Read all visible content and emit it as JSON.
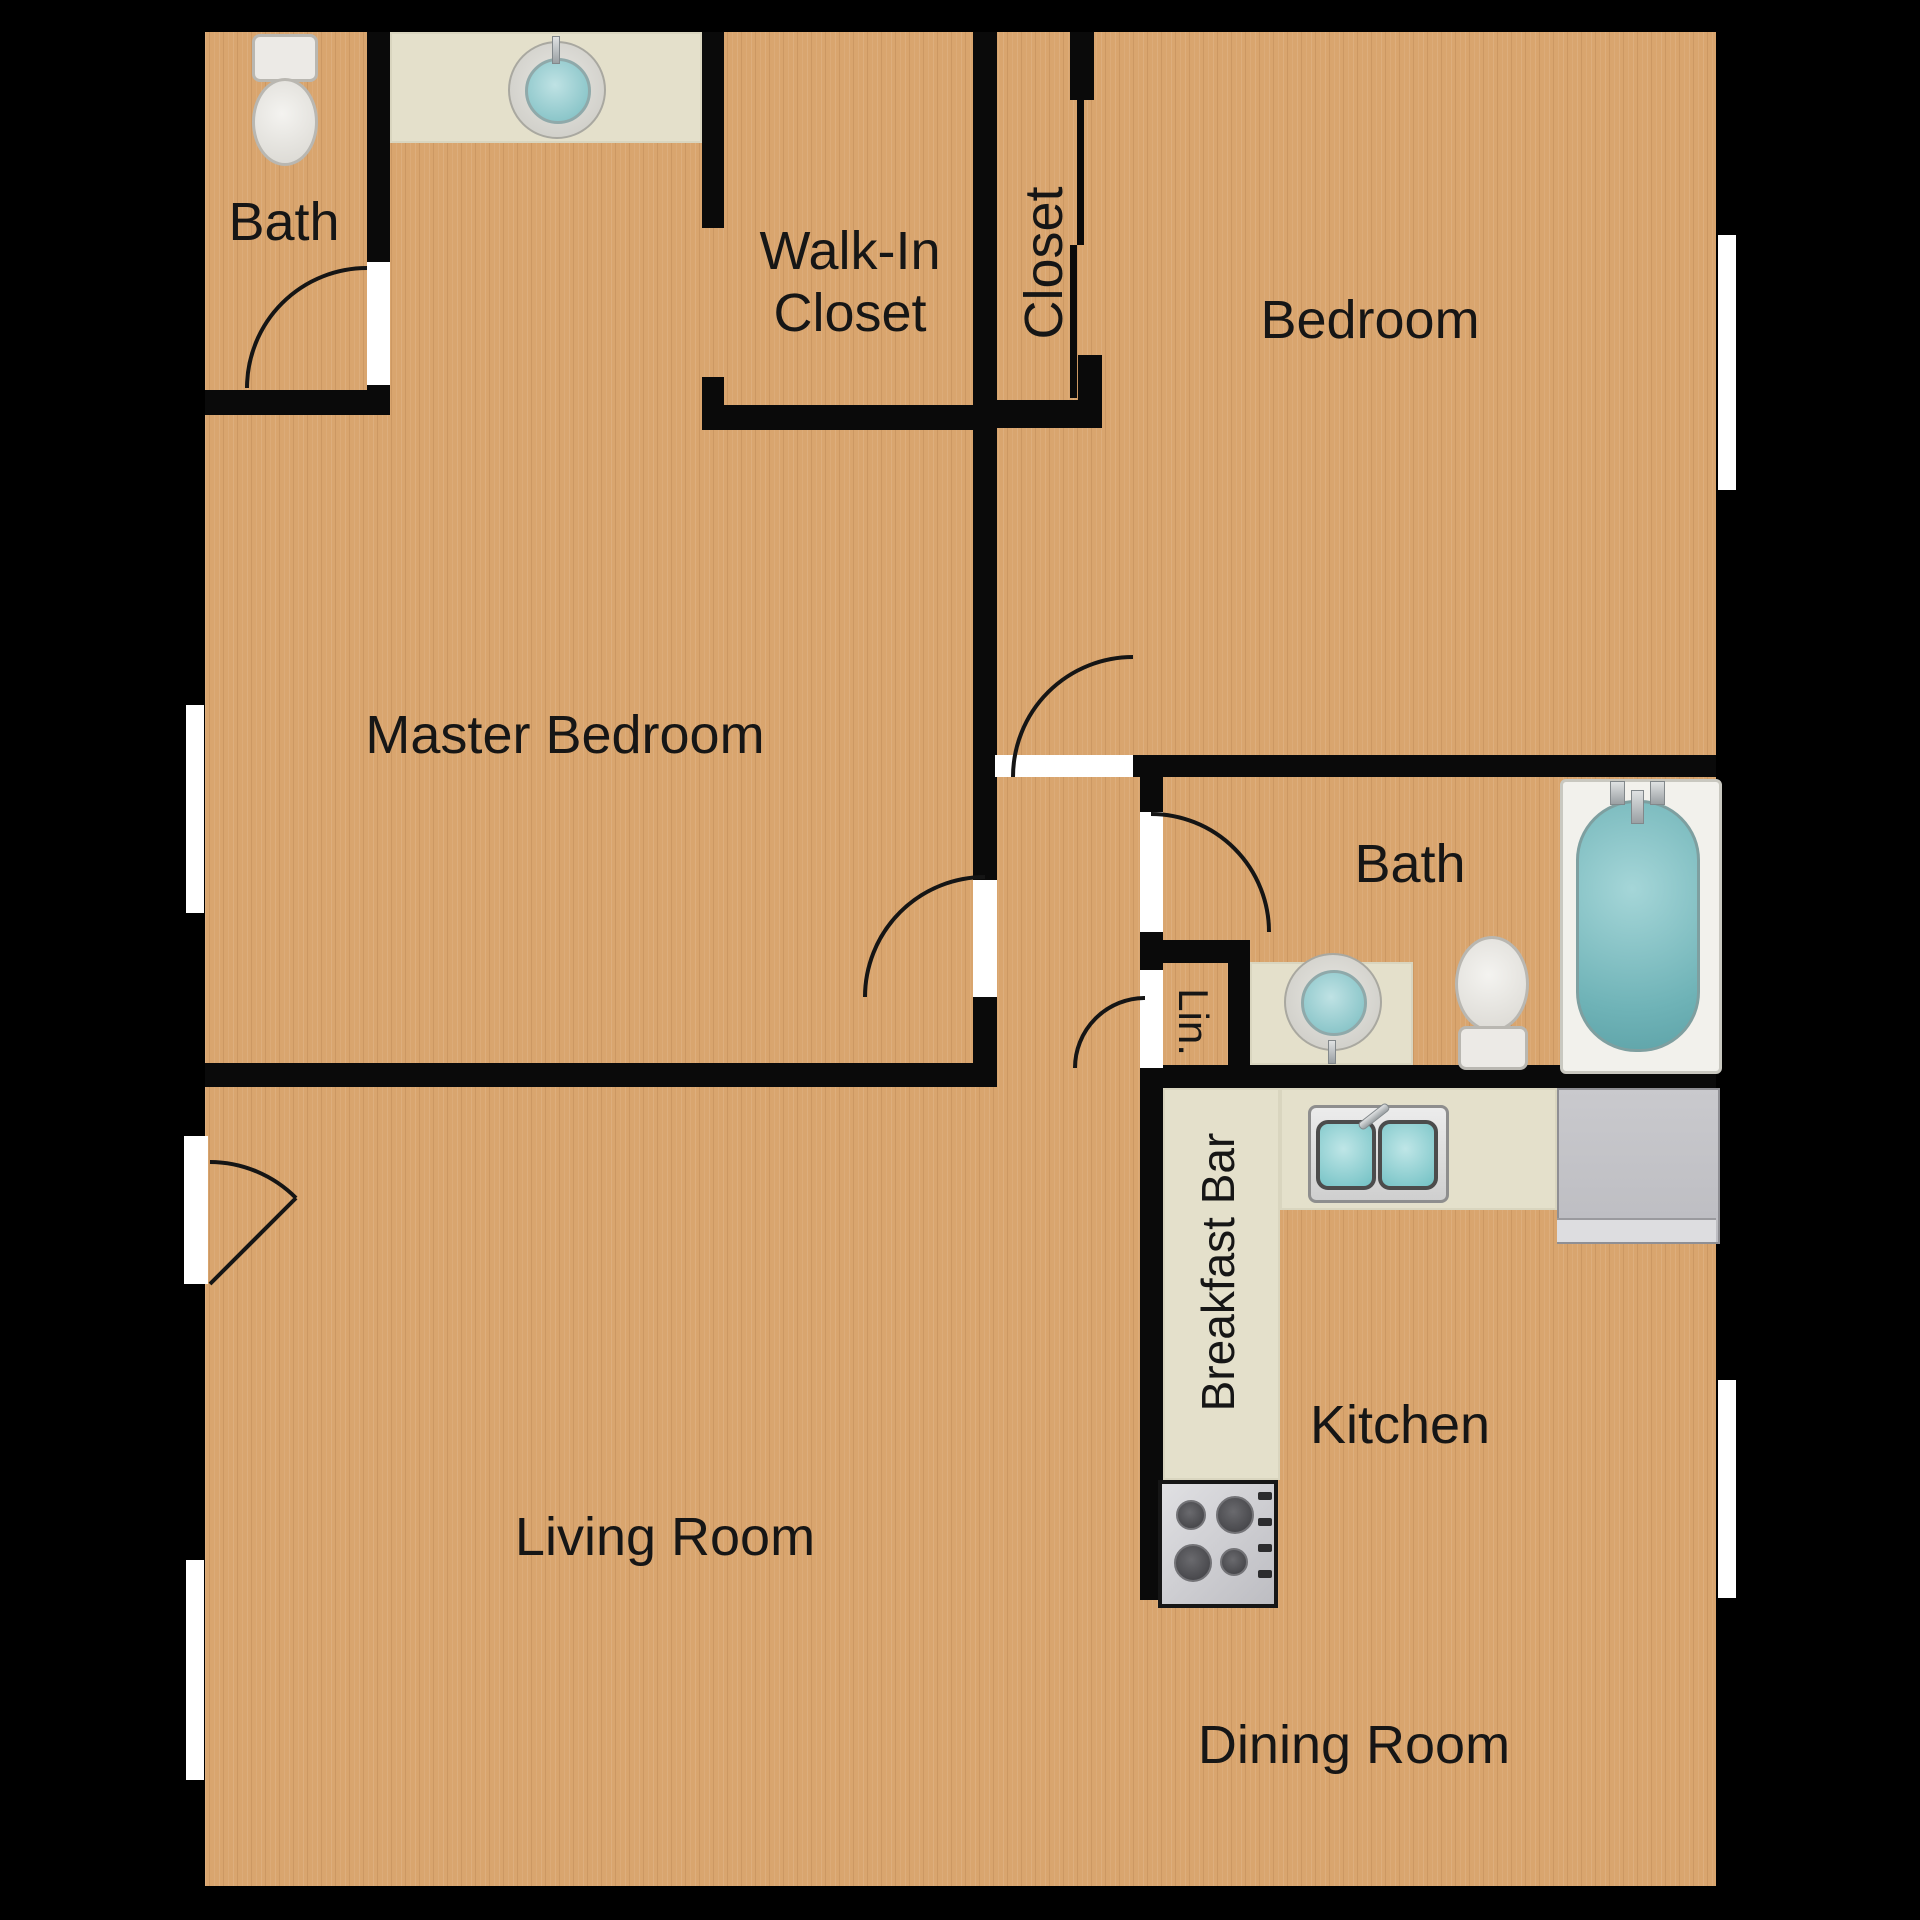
{
  "labels": {
    "bath_top": {
      "text": "Bath"
    },
    "walk_in_closet": {
      "text": "Walk-In\nCloset"
    },
    "closet": {
      "text": "Closet"
    },
    "bedroom": {
      "text": "Bedroom"
    },
    "master_bedroom": {
      "text": "Master Bedroom"
    },
    "bath_main": {
      "text": "Bath"
    },
    "linen": {
      "text": "Lin."
    },
    "breakfast_bar": {
      "text": "Breakfast Bar"
    },
    "kitchen": {
      "text": "Kitchen"
    },
    "living_room": {
      "text": "Living Room"
    },
    "dining_room": {
      "text": "Dining Room"
    }
  },
  "colors": {
    "background": "#000000",
    "floor_wood": "#d9a56e",
    "wall": "#0a0a0a",
    "counter_beige": "#e4e0cb",
    "fixture_teal": "#7cc2c5",
    "fixture_white": "#eceae6",
    "appliance_gray": "#c4c4c8",
    "door_opening_white": "#ffffff"
  },
  "fixtures": [
    "toilet",
    "round-vanity-sink",
    "bathtub",
    "double-kitchen-sink",
    "stove",
    "refrigerator"
  ]
}
